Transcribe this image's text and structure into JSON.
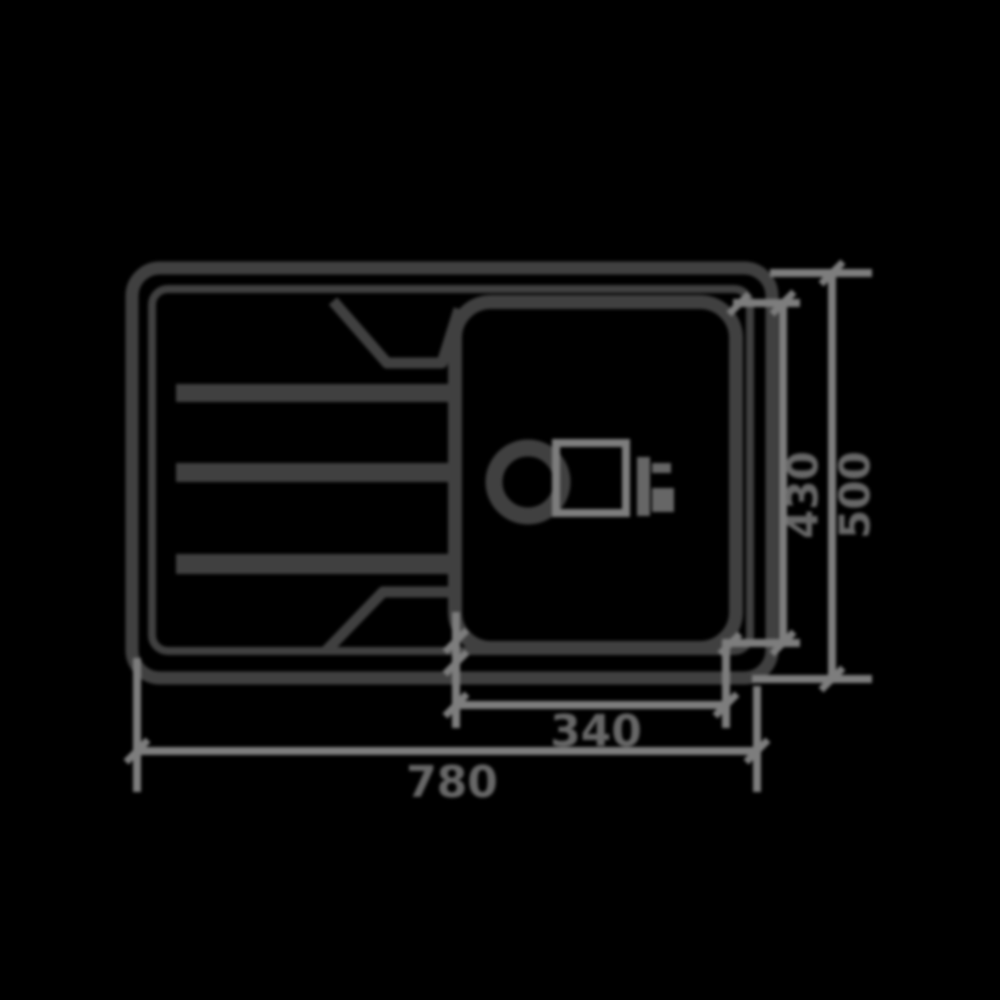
{
  "dimensions": {
    "overall_width": "780",
    "overall_depth": "500",
    "bowl_width": "340",
    "bowl_depth": "430"
  },
  "colors": {
    "background": "#000000",
    "outline": "#404040",
    "dim_lines": "#7d7d7d",
    "dim_text": "#676767",
    "fitting": "#666666"
  }
}
